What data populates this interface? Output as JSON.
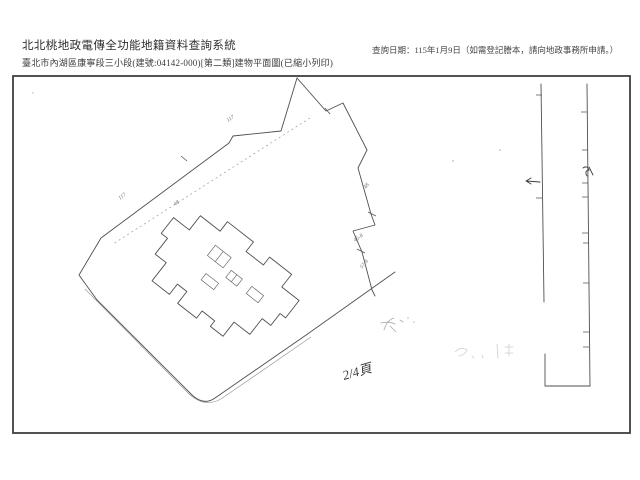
{
  "header": {
    "system_title": "北北桃地政電傳全功能地籍資料查詢系統",
    "document_line": "臺北市內湖區康寧段三小段(建號:04142-000)[第二類]建物平面圖(已縮小列印)",
    "query_date_note": "查詢日期：115年1月9日（如需登記謄本，請向地政事務所申請。）"
  },
  "plan": {
    "page_annotation": "2/4頁",
    "parcel_labels": [
      {
        "text": "117"
      },
      {
        "text": "117"
      },
      {
        "text": "48"
      },
      {
        "text": "48"
      },
      {
        "text": "45-8"
      },
      {
        "text": "57-4"
      }
    ],
    "colors": {
      "paper": "#ffffff",
      "frame": "#3f3f3f",
      "ink": "#4f4f4f",
      "faint_ink": "#9a9a9a"
    }
  }
}
